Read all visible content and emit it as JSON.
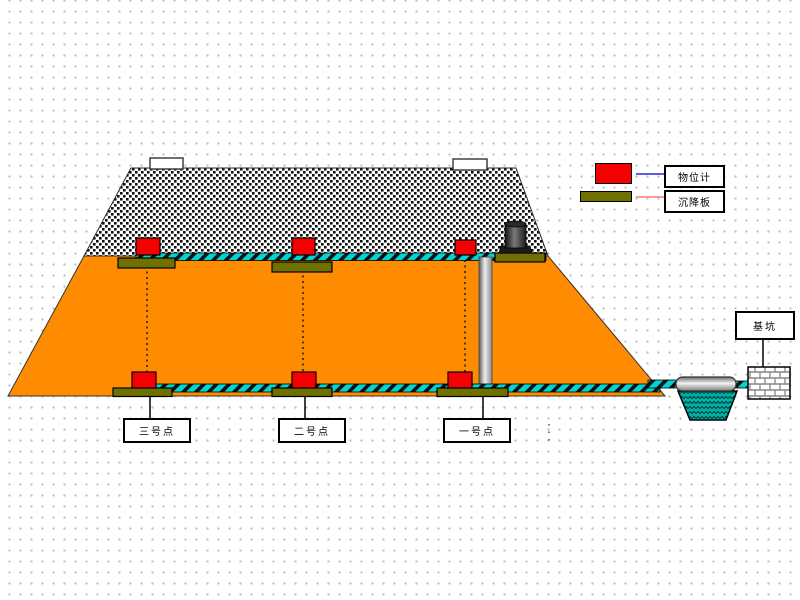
{
  "legend": {
    "items": [
      {
        "label": "物位计",
        "swatch_icon": "level-gauge-swatch",
        "swatch_color": "#f50000",
        "line_color": "#5c5ce6"
      },
      {
        "label": "沉降板",
        "swatch_icon": "settlement-plate-swatch",
        "swatch_color": "#6e7000",
        "line_color": "#ff9a9a"
      }
    ]
  },
  "labels": {
    "points": [
      {
        "label": "三号点"
      },
      {
        "label": "二号点"
      },
      {
        "label": "一号点"
      }
    ],
    "pit": "基坑"
  },
  "colors": {
    "embankment_fill": "#ff8c00",
    "gravel_layer": "#111111",
    "pipe_teal": "#00d4d4",
    "settlement_plate": "#6e7000",
    "sensor_red": "#f50000",
    "water_teal": "#00b4aa",
    "grid_dot": "#b9b9b9"
  }
}
